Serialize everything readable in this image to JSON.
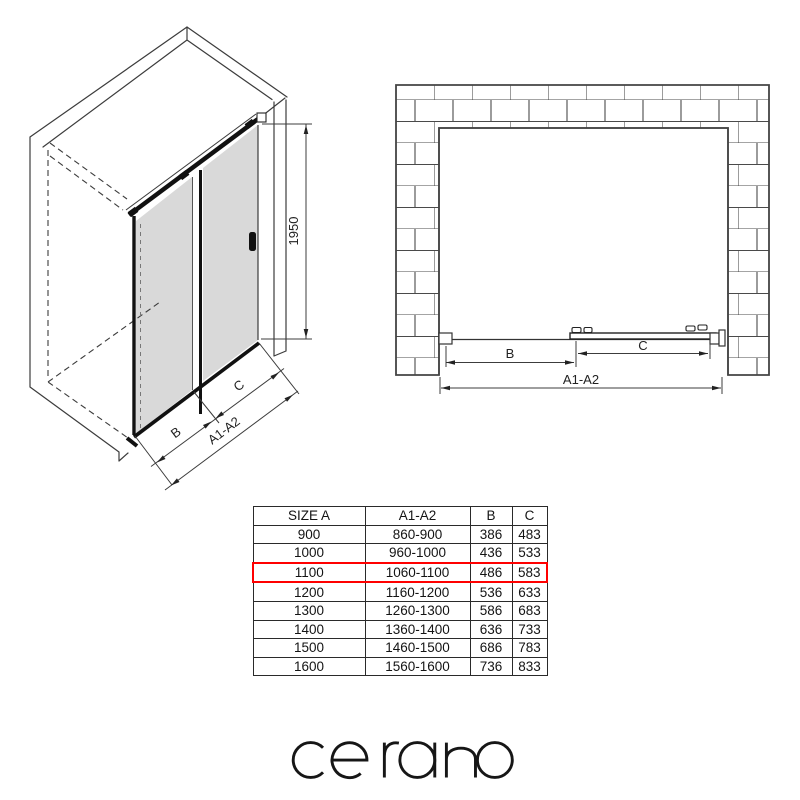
{
  "iso_view": {
    "height_dim": "1950",
    "dim_b": "B",
    "dim_c": "C",
    "dim_span": "A1-A2"
  },
  "plan_view": {
    "dim_b": "B",
    "dim_c": "C",
    "dim_span": "A1-A2"
  },
  "size_table": {
    "headers": [
      "SIZE A",
      "A1-A2",
      "B",
      "C"
    ],
    "rows": [
      [
        "900",
        "860-900",
        "386",
        "483"
      ],
      [
        "1000",
        "960-1000",
        "436",
        "533"
      ],
      [
        "1100",
        "1060-1100",
        "486",
        "583"
      ],
      [
        "1200",
        "1160-1200",
        "536",
        "633"
      ],
      [
        "1300",
        "1260-1300",
        "586",
        "683"
      ],
      [
        "1400",
        "1360-1400",
        "636",
        "733"
      ],
      [
        "1500",
        "1460-1500",
        "686",
        "783"
      ],
      [
        "1600",
        "1560-1600",
        "736",
        "833"
      ]
    ],
    "highlighted_row_index": 2,
    "highlight_color": "#ff0000"
  },
  "logo": {
    "text": "cerano"
  },
  "colors": {
    "glass": "#d9d9d9",
    "line": "#3c3c3c",
    "frame": "#111111",
    "highlight": "#ff0000"
  }
}
